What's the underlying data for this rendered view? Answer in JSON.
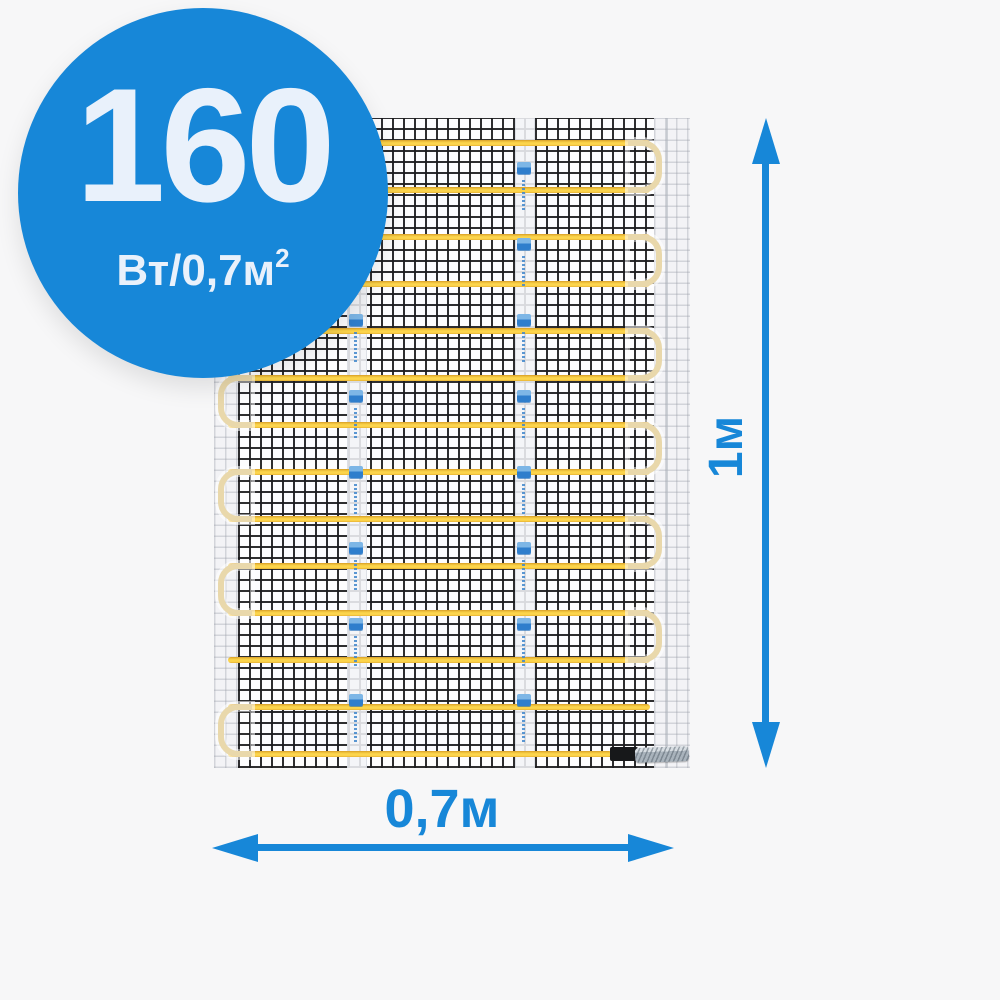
{
  "page": {
    "background_color": "#f7f7f8"
  },
  "badge": {
    "power_value": "160",
    "power_unit": "Вт/0,7м",
    "power_unit_sup": "2",
    "background_color": "#1787d8",
    "text_color": "#e9f1fb"
  },
  "product": {
    "name": "heating-mat",
    "cable_runs": 14,
    "right_loop_rows": [
      0,
      2,
      4,
      6,
      8,
      10
    ],
    "left_loop_rows": [
      1,
      3,
      5,
      7,
      9,
      12
    ],
    "tape_count": 2,
    "stamps_per_tape": 8,
    "mesh_line_color": "#1c1c1f",
    "cable_color_bright": "#ffd94f",
    "cable_color_dark": "#d89e26",
    "loop_color": "#e9d8ab",
    "tape_stamp_icon": "brand-stamp-icon",
    "end_cap_color": "#17181a",
    "crimp_color": "#b7c0c8"
  },
  "dimensions": {
    "height_label": "1м",
    "width_label": "0,7м",
    "arrow_color": "#1787d8"
  }
}
